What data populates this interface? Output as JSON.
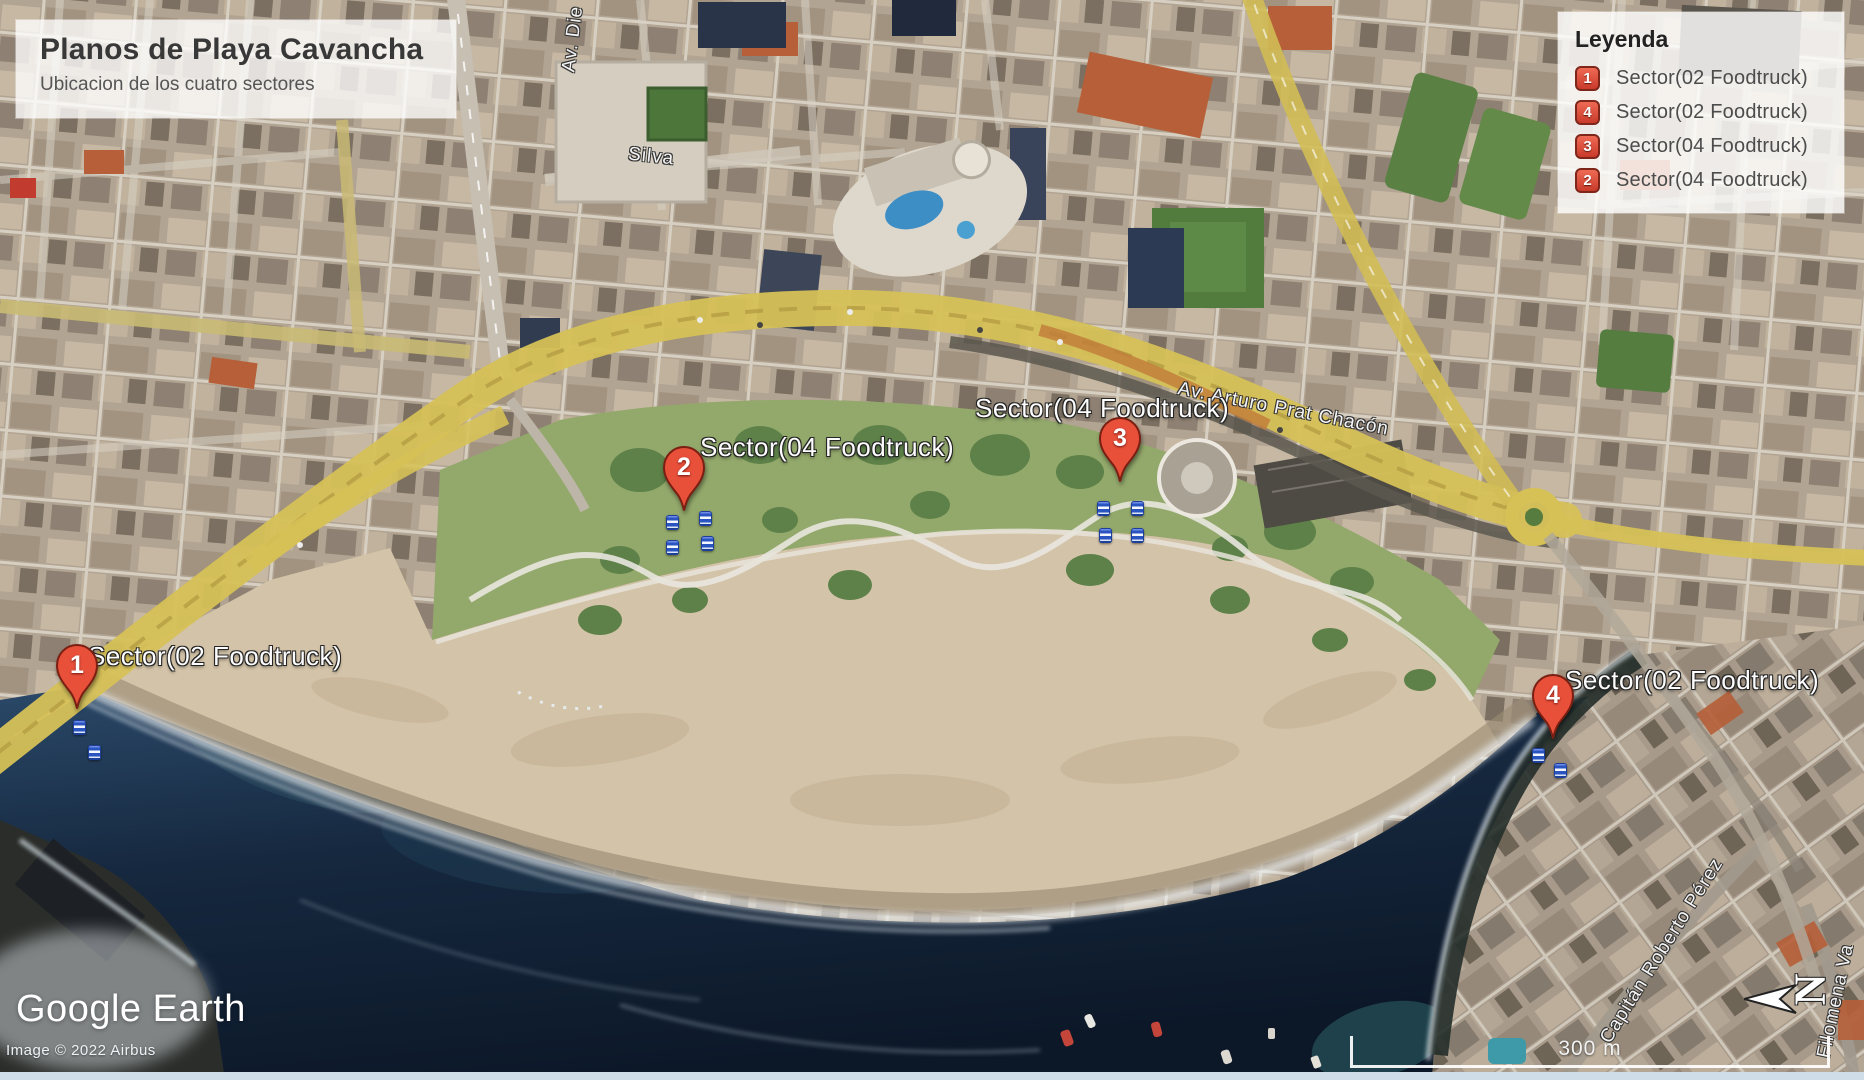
{
  "title_box": {
    "title": "Planos de Playa Cavancha",
    "subtitle": "Ubicacion de los cuatro sectores"
  },
  "legend": {
    "title": "Leyenda",
    "items": [
      {
        "number": "1",
        "label": "Sector(02 Foodtruck)"
      },
      {
        "number": "4",
        "label": "Sector(02 Foodtruck)"
      },
      {
        "number": "3",
        "label": "Sector(04 Foodtruck)"
      },
      {
        "number": "2",
        "label": "Sector(04 Foodtruck)"
      }
    ]
  },
  "markers": [
    {
      "number": "1",
      "label": "Sector(02 Foodtruck)"
    },
    {
      "number": "2",
      "label": "Sector(04 Foodtruck)"
    },
    {
      "number": "3",
      "label": "Sector(04 Foodtruck)"
    },
    {
      "number": "4",
      "label": "Sector(02 Foodtruck)"
    }
  ],
  "streets": {
    "av_arturo_prat": "Av. Arturo Prat Chacón",
    "silva": "Silva",
    "av_die": "Av. Die",
    "capitan_roberto": "Capitán Roberto Pérez",
    "filomena": "Filomena Va"
  },
  "map_controls": {
    "north_label": "N",
    "scale_label": "300 m"
  },
  "branding": {
    "logo": "Google Earth",
    "attribution": "Image © 2022 Airbus"
  },
  "icons": {
    "pin": "map-pin-icon",
    "foodtruck": "foodtruck-icon",
    "north": "north-arrow-icon"
  },
  "colors": {
    "pin_red": "#e8503a",
    "badge_red": "#d8473a",
    "road_yellow": "#d6c157",
    "ocean_deep": "#101d31",
    "sand": "#d3c3a8",
    "park_green": "#93a86b",
    "foodtruck_blue": "#2a54c0"
  }
}
